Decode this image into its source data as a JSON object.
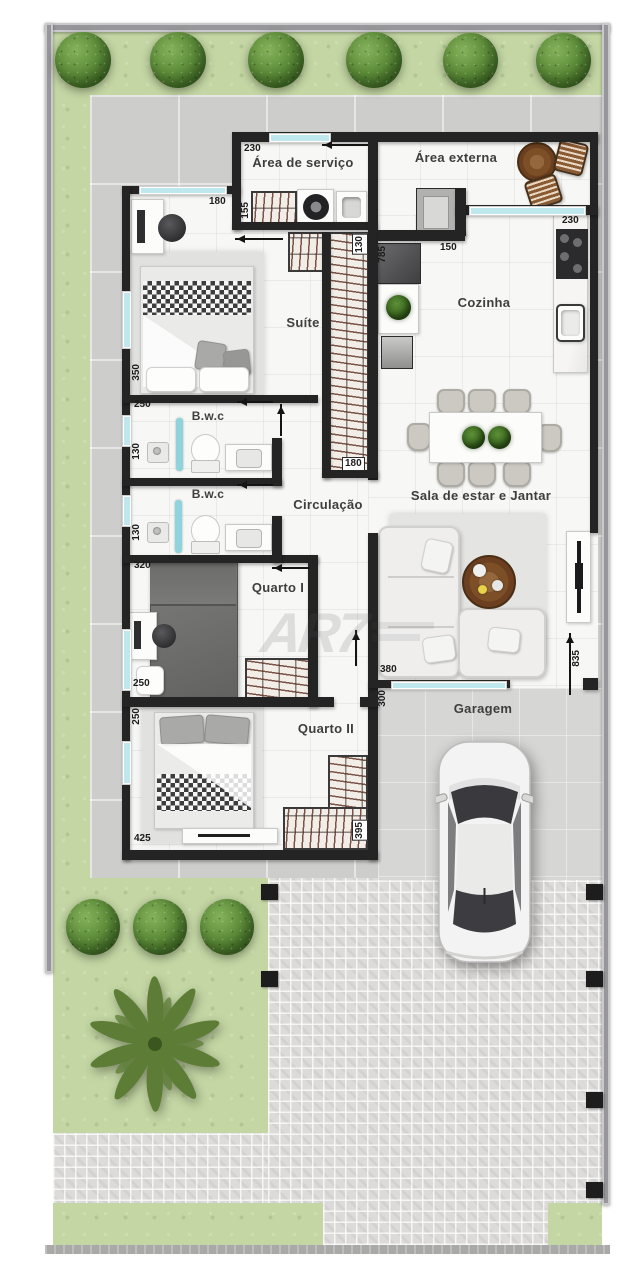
{
  "plan_title": "residential floor plan (top view)",
  "watermark": {
    "text": "AR7"
  },
  "rooms": {
    "servico": {
      "label": "Área de serviço"
    },
    "externa": {
      "label": "Área externa"
    },
    "suite": {
      "label": "Suíte"
    },
    "cozinha": {
      "label": "Cozinha"
    },
    "bwc1": {
      "label": "B.w.c"
    },
    "bwc2": {
      "label": "B.w.c"
    },
    "circulacao": {
      "label": "Circulação"
    },
    "quarto1": {
      "label": "Quarto I"
    },
    "sala": {
      "label": "Sala de estar e Jantar"
    },
    "quarto2": {
      "label": "Quarto II"
    },
    "garagem": {
      "label": "Garagem"
    }
  },
  "dimensions": {
    "servico_w": "230",
    "suite_w": "180",
    "servico_h": "155",
    "closet_top": "130",
    "kitchen_isle": "785",
    "externa_door": "150",
    "kitchen_w": "230",
    "suite_len": "350",
    "suite_bot": "250",
    "bwc1_h": "130",
    "bwc2_h": "130",
    "q1_top": "320",
    "q1_bot": "250",
    "q2_left": "250",
    "q2_bot": "425",
    "closet_bot": "180",
    "q2_closet": "395",
    "sala_w": "380",
    "garage_w": "300",
    "garage_len": "835"
  },
  "colors": {
    "wall": "#242424",
    "window_glass": "#bfe7ee",
    "lawn": "#c3d6a3",
    "patio": "#cdcdcb",
    "paver": "#dcdbd9",
    "floor": "#f7f7f5",
    "closet_hatch_line": "#5c2d20",
    "wood": "#7d4f27"
  }
}
